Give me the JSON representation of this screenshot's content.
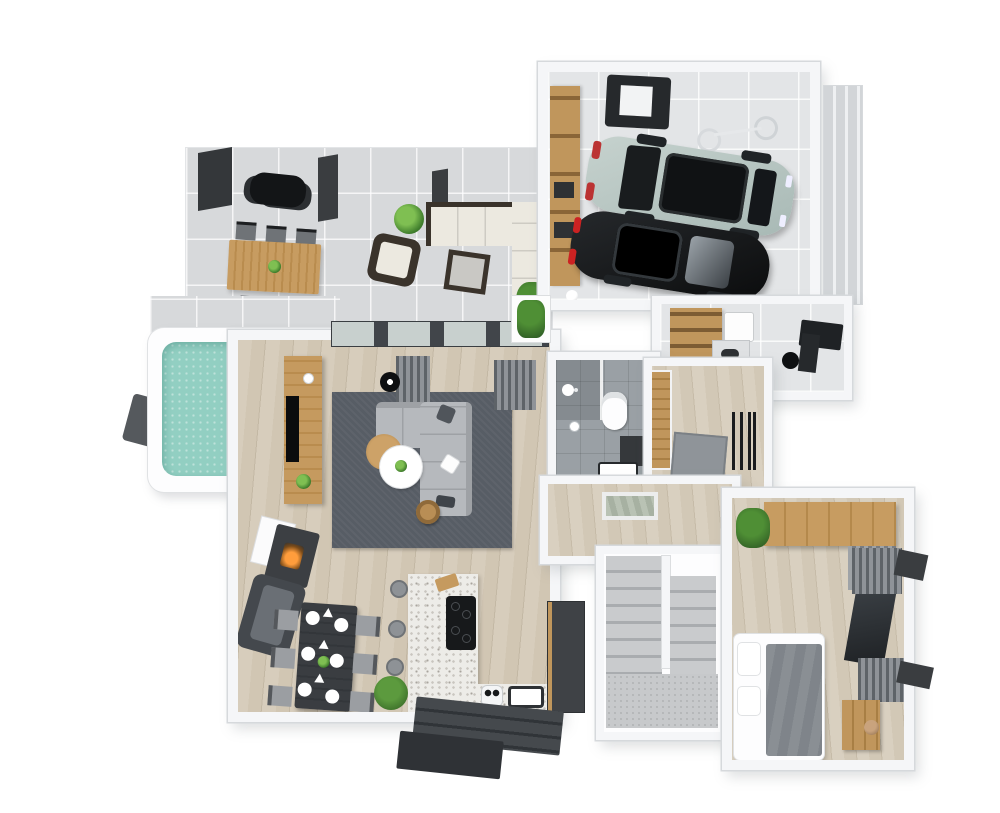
{
  "scene": {
    "title": "3D rendered floor plan, ground floor with garage, terrace and plunge pool",
    "style": "top-down 3D architectural render, white walls, oak floors, gray textiles",
    "background": "#ffffff",
    "palette": {
      "wall": "#f5f6f8",
      "wall_edge": "#d6d9dc",
      "oak_floor": "#d1c6b3",
      "terrace_tile": "#d7d9db",
      "garage_concrete": "#e3e5e7",
      "terrazzo_counter": "#edece8",
      "bath_tile": "#9aa0a5",
      "rug_gray": "#575d65",
      "sofa_gray": "#b6b9bd",
      "pool_water": "#92cfc2",
      "deck_dark": "#55595d",
      "wood_furniture": "#c0965c",
      "dark_furniture": "#2e3134",
      "suv_green": "#b9c7c3",
      "sedan_black": "#141618",
      "fire_orange": "#ff9d3c"
    },
    "rooms": [
      {
        "id": "terrace",
        "label": "Terrace",
        "floor": "concrete tiles",
        "furniture": [
          "BBQ grill",
          "Outdoor dining table",
          "6 outdoor chairs",
          "Rattan corner sofa",
          "Rattan armchair",
          "Rattan ottoman",
          "Potted plants",
          "Pergola posts"
        ]
      },
      {
        "id": "pool",
        "label": "Plunge pool",
        "floor": "water",
        "furniture": [
          "White coping",
          "Dark wood deck"
        ]
      },
      {
        "id": "garage",
        "label": "Garage",
        "floor": "concrete",
        "furniture": [
          "Light green SUV",
          "Black sedan",
          "Wall-mounted bicycle",
          "Storage shelves",
          "Workbench",
          "Soccer ball",
          "Sectional garage door"
        ]
      },
      {
        "id": "utility",
        "label": "Utility room",
        "floor": "concrete",
        "furniture": [
          "Shelf with baskets",
          "Washing machine",
          "Worktop",
          "Desk",
          "Desk chair"
        ]
      },
      {
        "id": "living",
        "label": "Living room",
        "floor": "oak planks",
        "furniture": [
          "Area rug",
          "Corner sofa",
          "Throw pillows",
          "Round coffee tables",
          "Side table",
          "TV sideboard",
          "Television",
          "Fireplace",
          "Armchair",
          "Floor lamp",
          "Curtains",
          "Sliding glass doors",
          "Planter box"
        ]
      },
      {
        "id": "kitchen",
        "label": "Kitchen / dining",
        "floor": "oak planks",
        "furniture": [
          "Dining table for six",
          "6 dining chairs",
          "Place settings",
          "Terrazzo island",
          "Induction hob",
          "Cutting board",
          "3 bar stools",
          "Sink",
          "Food processor",
          "Tall cabinets",
          "Potted plant",
          "Back steps"
        ]
      },
      {
        "id": "bathroom",
        "label": "Bathroom",
        "floor": "gray tile",
        "furniture": [
          "Wall-hung toilet",
          "Shower",
          "Vanity basin",
          "Toilet-paper holder"
        ]
      },
      {
        "id": "entry",
        "label": "Entry hall",
        "floor": "oak planks",
        "furniture": [
          "Front door",
          "Doormat",
          "Coat rack"
        ]
      },
      {
        "id": "hallway",
        "label": "Hallway",
        "floor": "oak planks",
        "furniture": [
          "Glass floor light"
        ]
      },
      {
        "id": "stairs",
        "label": "Staircase",
        "floor": "gray carpet",
        "furniture": [
          "U-shaped double flight",
          "Landing"
        ]
      },
      {
        "id": "bedroom",
        "label": "Bedroom",
        "floor": "oak planks",
        "furniture": [
          "Double bed",
          "Gray duvet",
          "White pillows",
          "Wardrobe",
          "Louvre front",
          "Curtains",
          "Dresser",
          "Vase",
          "Potted plant"
        ]
      }
    ],
    "items": {
      "plan": "Ground-floor 3D plan",
      "terrace": "Terrace",
      "terrace_walkway": "Terrace walkway to pool",
      "pergola_post": "Pergola post",
      "bbq": "BBQ grill",
      "outdoor_table": "Outdoor dining table",
      "outdoor_chair": "Outdoor dining chair",
      "lounge_sofa": "Rattan corner sofa with white cushions",
      "lounge_chair": "Rattan armchair",
      "ottoman": "Rattan ottoman",
      "plant": "Potted plant",
      "planter": "Planter box",
      "pool": "Plunge pool",
      "pool_water": "Pool water",
      "pool_deck": "Pool deck",
      "garage": "Garage",
      "garage_door": "Sectional garage door",
      "suv": "Light green SUV",
      "sedan": "Black sedan",
      "bicycle": "Wall-mounted bicycle",
      "shelves": "Garage storage shelves",
      "workbench": "Workbench",
      "ball": "Soccer ball",
      "utility": "Utility room",
      "shelf_baskets": "Shelf with baskets",
      "washer": "Washing machine",
      "worktop": "Utility worktop",
      "desk": "Desk",
      "desk_chair": "Desk chair",
      "living": "Living room",
      "window_band": "Sliding glass doors",
      "curtain": "Curtain",
      "floor_lamp": "Floor lamp",
      "sideboard": "TV sideboard",
      "tv": "Television",
      "candle": "Candle",
      "rug": "Area rug",
      "sofa": "Corner sofa",
      "pillow": "Throw pillow",
      "coffee_table_wood": "Round wooden coffee table",
      "coffee_table_white": "Round white coffee table",
      "side_table": "Side table",
      "fireplace": "Fireplace",
      "armchair": "Armchair",
      "kitchen": "Kitchen and dining area",
      "dining_table": "Dining table",
      "dining_chair": "Dining chair",
      "plate": "Place setting",
      "centerpiece": "Table centerpiece",
      "island": "Terrazzo kitchen island",
      "hob": "Induction hob",
      "board": "Cutting board",
      "stool": "Bar stool",
      "counter": "Kitchen counter",
      "sink": "Kitchen sink",
      "appliance": "Food processor",
      "tall_units": "Tall kitchen cabinets",
      "back_steps": "Back-door steps",
      "porch": "Back porch",
      "bathroom": "Bathroom",
      "toilet": "Wall-hung toilet",
      "shower": "Shower",
      "shower_glass": "Shower glass screen",
      "vanity": "Vanity cabinet",
      "basin": "Washbasin",
      "tp_holder": "Toilet-paper holder",
      "entry": "Entry hall",
      "door": "Front door",
      "doormat": "Doormat",
      "coat_rack": "Coat rack",
      "hallway": "Hallway",
      "floor_light": "Glass floor light",
      "stairs": "Staircase",
      "flight": "Stair flight",
      "landing": "Stair landing",
      "bedroom": "Bedroom",
      "bed": "Double bed",
      "duvet": "Gray duvet",
      "bed_pillow": "Pillow",
      "wardrobe": "Wardrobe",
      "louvre": "Louvre wardrobe front",
      "window_glass": "Window",
      "dresser": "Dresser",
      "vase": "Ceramic vase",
      "sill": "Exterior window sill"
    }
  }
}
